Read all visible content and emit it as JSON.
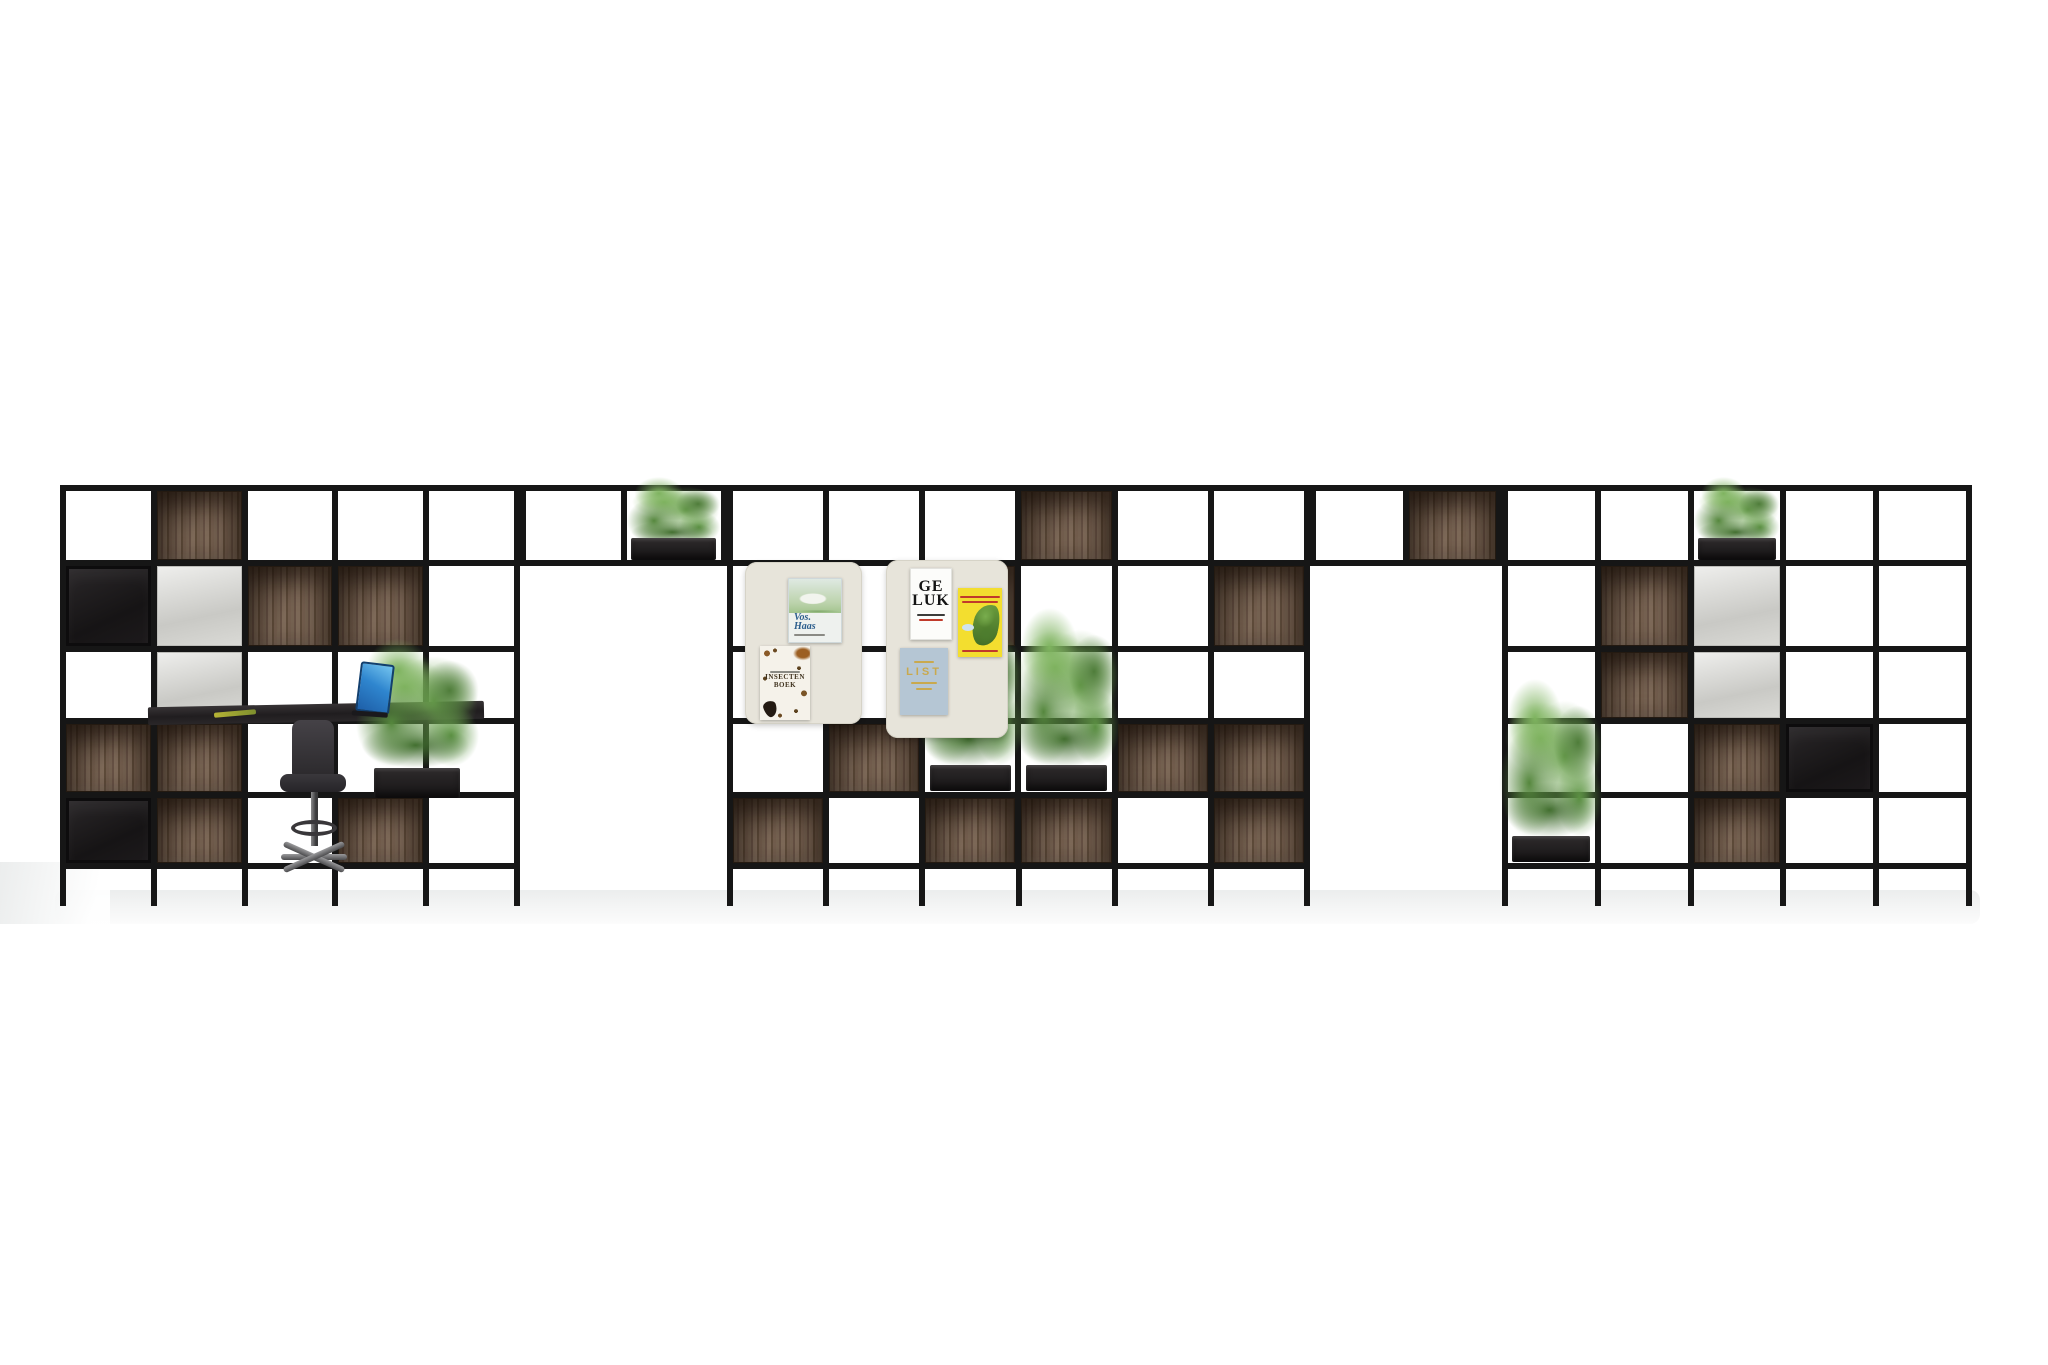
{
  "colors": {
    "background": "#ffffff",
    "frame": "#161616",
    "wood": "#6a5645",
    "wood_shadow": "#473729",
    "black_box": "#1d1b1c",
    "white_panel": "#d9d9d5",
    "planter_box": "#232021",
    "foliage_green": "#5f9347",
    "pinboard_cream": "#e7e4da",
    "floor_shadow": "#e9ebeb",
    "desk": "#29262a",
    "stool": "#323034",
    "laptop_blue": "#2f86cf",
    "poster_yellow": "#f3de2f",
    "poster_blue": "#b5c6d4",
    "poster_gold": "#c9a94e",
    "poster_red": "#c03a2b",
    "vos_title_blue": "#2b5d8c"
  },
  "posters": {
    "left_board": {
      "vos_haas": {
        "line1": "Vos.",
        "line2": "Haas"
      },
      "insectenboek": {
        "line1": "INSECTEN",
        "line2": "BOEK"
      }
    },
    "right_board": {
      "geluk": {
        "line1": "GE",
        "line2": "LUK"
      },
      "list": {
        "title": "LIST"
      }
    }
  },
  "scene": {
    "frame_color": "#161616",
    "row_heights": [
      69,
      80,
      66,
      68,
      65
    ],
    "sections": [
      {
        "id": "left",
        "x": 60,
        "y": 485,
        "w": 460,
        "cols": 5,
        "cells": [
          [
            "open",
            "wood",
            "open",
            "open",
            "open"
          ],
          [
            "black",
            "panel",
            "wood",
            "wood",
            "open"
          ],
          [
            "open",
            "panel",
            "open",
            "open",
            "open"
          ],
          [
            "wood",
            "wood",
            "open",
            "open",
            "open"
          ],
          [
            "black",
            "wood",
            "open",
            "wood",
            "open"
          ]
        ]
      },
      {
        "id": "bridge-left",
        "x": 520,
        "y": 485,
        "w": 207,
        "cols": 2,
        "rows": [
          69
        ],
        "no_legs": true,
        "cells": [
          [
            "open",
            "plantbox"
          ]
        ]
      },
      {
        "id": "middle",
        "x": 727,
        "y": 485,
        "w": 583,
        "cols": 6,
        "cells": [
          [
            "open",
            "open",
            "open",
            "wood",
            "open",
            "open"
          ],
          [
            "open",
            "open",
            "wood",
            "open",
            "open",
            "wood"
          ],
          [
            "open",
            "open",
            "open",
            "open",
            "open",
            "open"
          ],
          [
            "open",
            "wood",
            "planter",
            "planter",
            "wood",
            "wood"
          ],
          [
            "wood",
            "open",
            "wood",
            "wood",
            "open",
            "wood"
          ]
        ]
      },
      {
        "id": "bridge-right",
        "x": 1310,
        "y": 485,
        "w": 192,
        "cols": 2,
        "rows": [
          69
        ],
        "no_legs": true,
        "cells": [
          [
            "open",
            "wood"
          ]
        ]
      },
      {
        "id": "right",
        "x": 1502,
        "y": 485,
        "w": 470,
        "cols": 5,
        "cells": [
          [
            "open",
            "open",
            "plantbox",
            "open",
            "open"
          ],
          [
            "open",
            "wood",
            "panel",
            "open",
            "open"
          ],
          [
            "open",
            "wood",
            "panel",
            "open",
            "open"
          ],
          [
            "open",
            "open",
            "wood",
            "black",
            "open"
          ],
          [
            "planter",
            "open",
            "wood",
            "open",
            "open"
          ]
        ]
      }
    ]
  }
}
